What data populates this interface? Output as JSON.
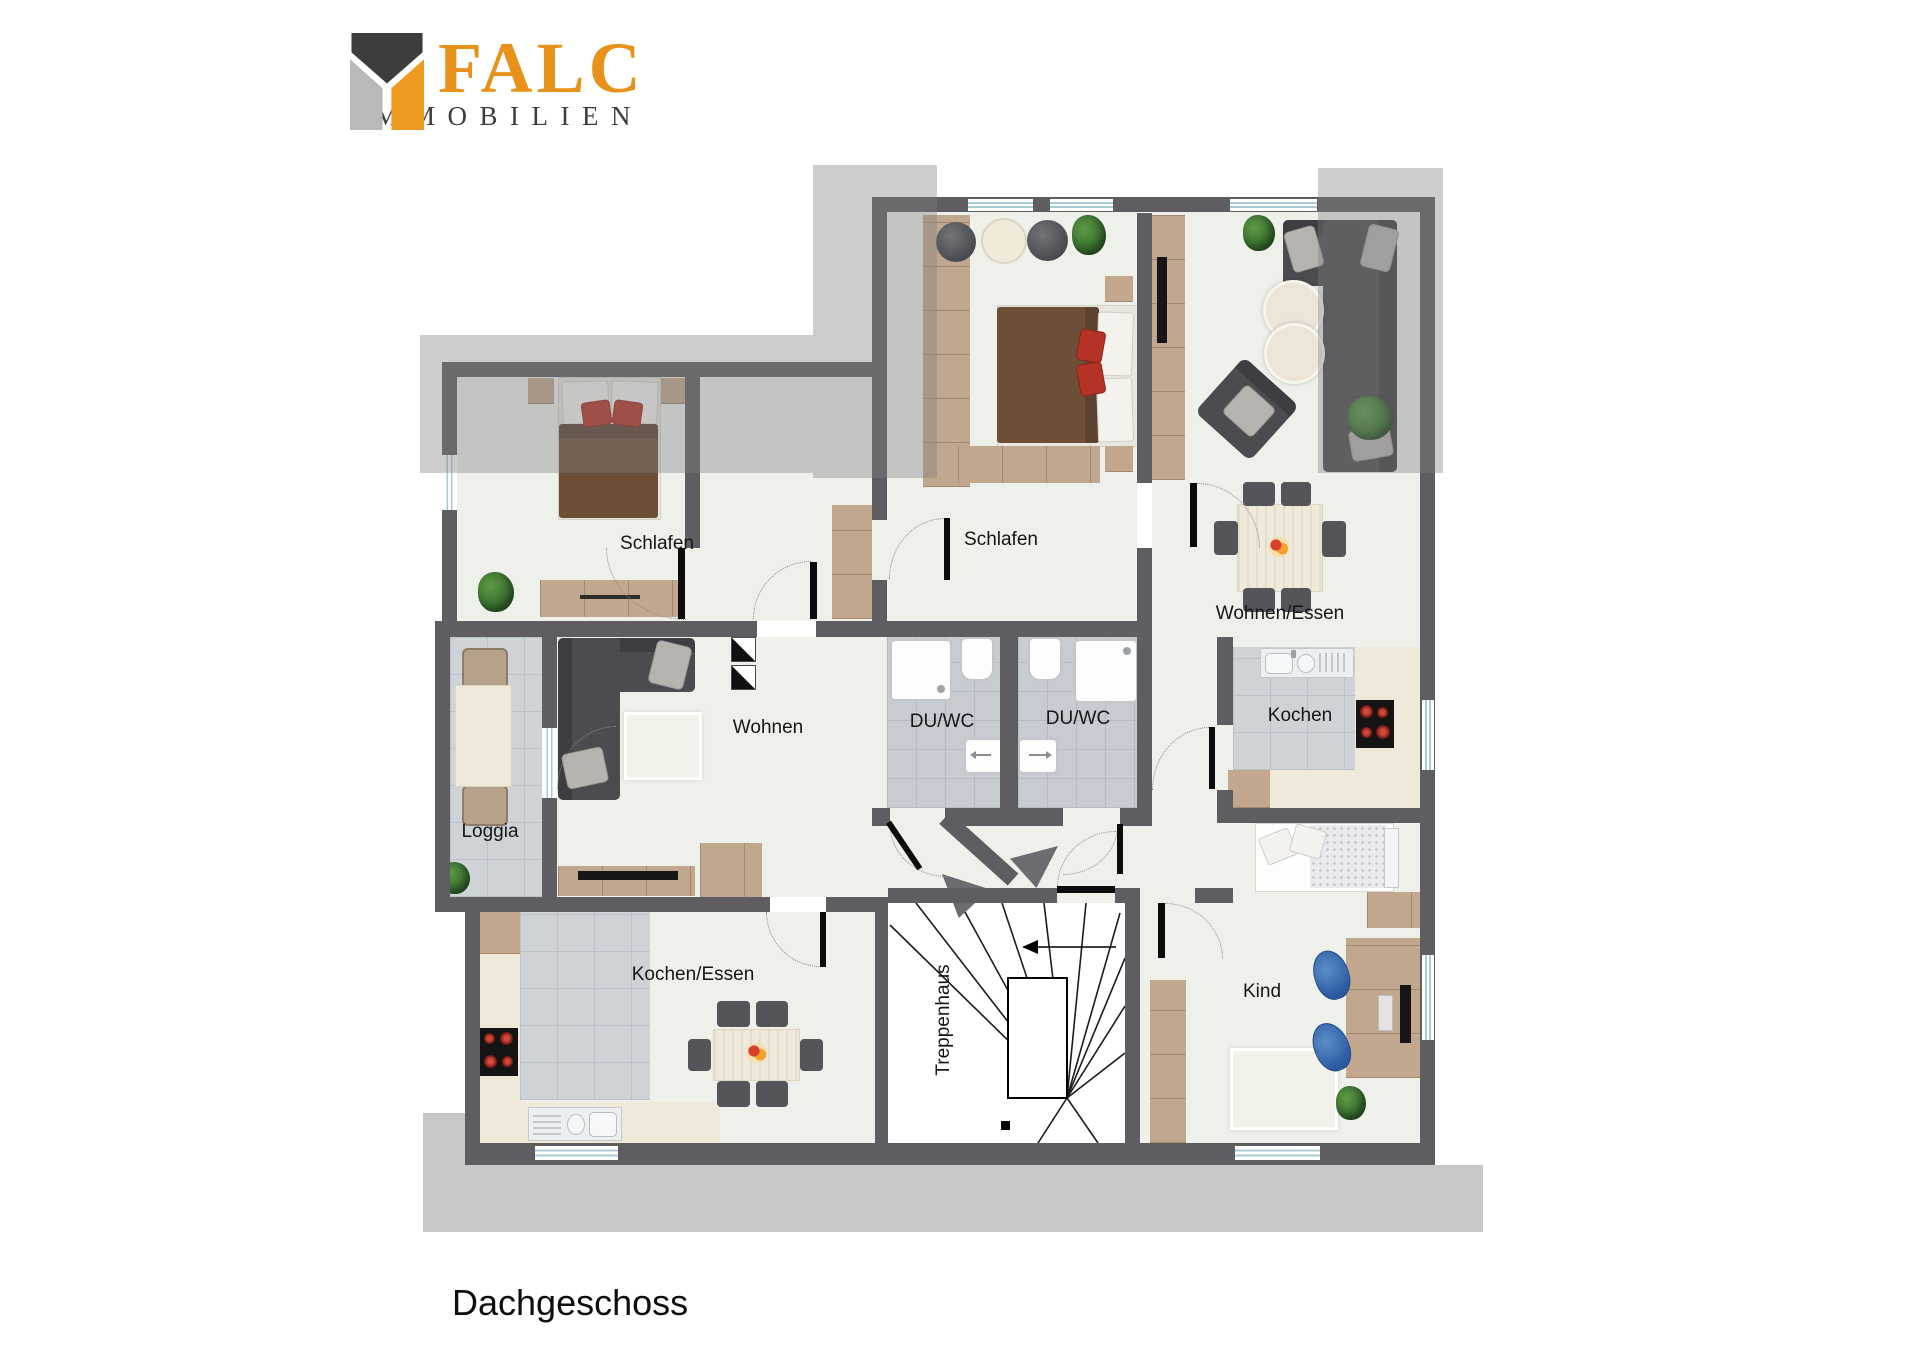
{
  "logo": {
    "brand": "FALC",
    "subtitle": "IMMOBILIEN"
  },
  "floor_title": "Dachgeschoss",
  "rooms": {
    "schlafen_left": {
      "label": "Schlafen"
    },
    "schlafen_top": {
      "label": "Schlafen"
    },
    "wohnen_essen": {
      "label": "Wohnen/Essen"
    },
    "wohnen": {
      "label": "Wohnen"
    },
    "duwc_left": {
      "label": "DU/WC"
    },
    "duwc_right": {
      "label": "DU/WC"
    },
    "kochen": {
      "label": "Kochen"
    },
    "loggia": {
      "label": "Loggia"
    },
    "kochen_essen": {
      "label": "Kochen/Essen"
    },
    "treppenhaus": {
      "label": "Treppenhaus"
    },
    "kind": {
      "label": "Kind"
    }
  },
  "colors": {
    "wall": "#5e5e62",
    "floor": "#eef0ea",
    "tile": "#c7ccd2",
    "wood": "#c0a78d",
    "sofa": "#4c4c50",
    "bed_brown": "#6d4f38",
    "accent_red": "#b43226",
    "logo_orange": "#e8921c",
    "roof_overlay": "rgba(126,126,129,0.38)",
    "window_blue": "#a9ccd4"
  }
}
